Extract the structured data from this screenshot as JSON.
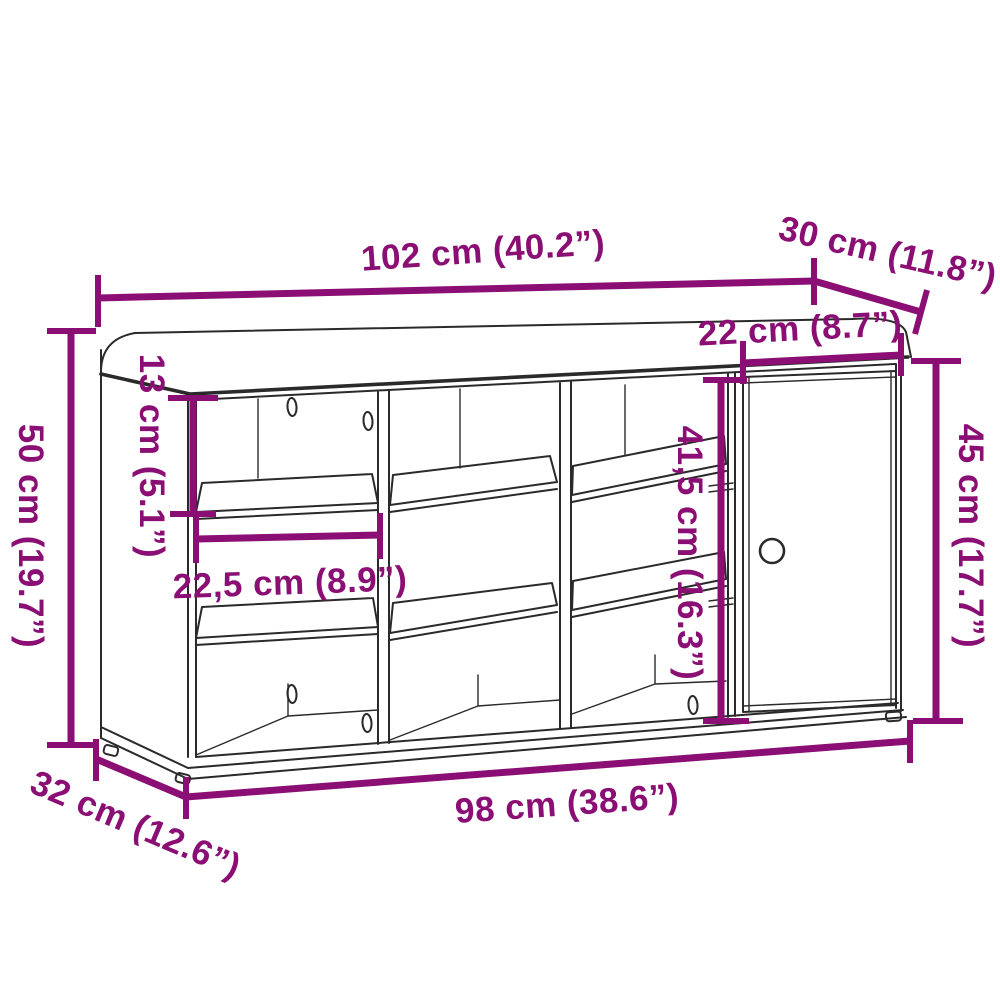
{
  "diagram": {
    "type": "product-dimension-diagram",
    "product": "shoe-storage-bench-with-cushion-compartments-and-door",
    "background_color": "#ffffff",
    "annotation_color": "#8A0E73",
    "outline_color": "#2a2a2a",
    "dimensions": {
      "top_width": "102 cm (40.2”)",
      "top_depth": "30 cm (11.8”)",
      "door_width": "22 cm (8.7”)",
      "overall_height": "50 cm (19.7”)",
      "top_compartment_height": "13 cm (5.1”)",
      "compartment_width": "22,5 cm (8.9”)",
      "interior_height": "41,5 cm (16.3”)",
      "door_height": "45 cm (17.7”)",
      "base_depth": "32 cm (12.6”)",
      "base_width": "98 cm (38.6”)"
    }
  }
}
